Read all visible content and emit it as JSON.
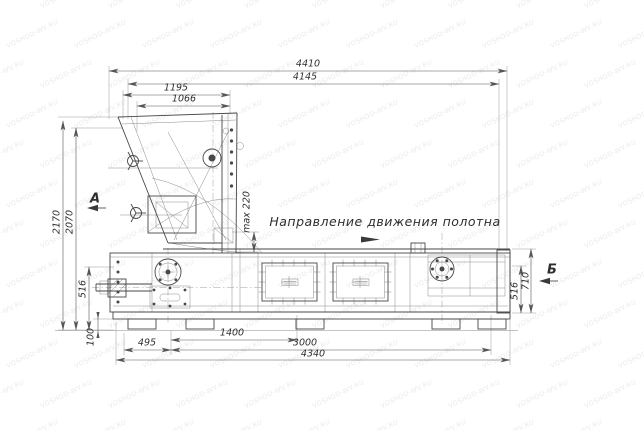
{
  "title": "Техническая схема машины (габаритный чертеж)",
  "annotations": {
    "direction": "Направление движения полотна",
    "view_a": "А",
    "view_b": "Б"
  },
  "dimensions": {
    "d4410": "4410",
    "d4145": "4145",
    "d1195": "1195",
    "d1066": "1066",
    "d2170": "2170",
    "d2070": "2070",
    "d516_left": "516",
    "d100": "100",
    "dmax220": "max 220",
    "d1400": "1400",
    "d495": "495",
    "d3000": "3000",
    "d4340": "4340",
    "d710": "710",
    "d516_right": "516"
  },
  "watermark": {
    "text": "VOSHOD-WV.RU"
  },
  "colors": {
    "background": "#ffffff",
    "main_line": "#474747",
    "thin_line": "#8a8a8a",
    "dim_line": "#555555",
    "text": "#2e2e2e",
    "watermark": "rgba(105,105,115,0.15)"
  }
}
